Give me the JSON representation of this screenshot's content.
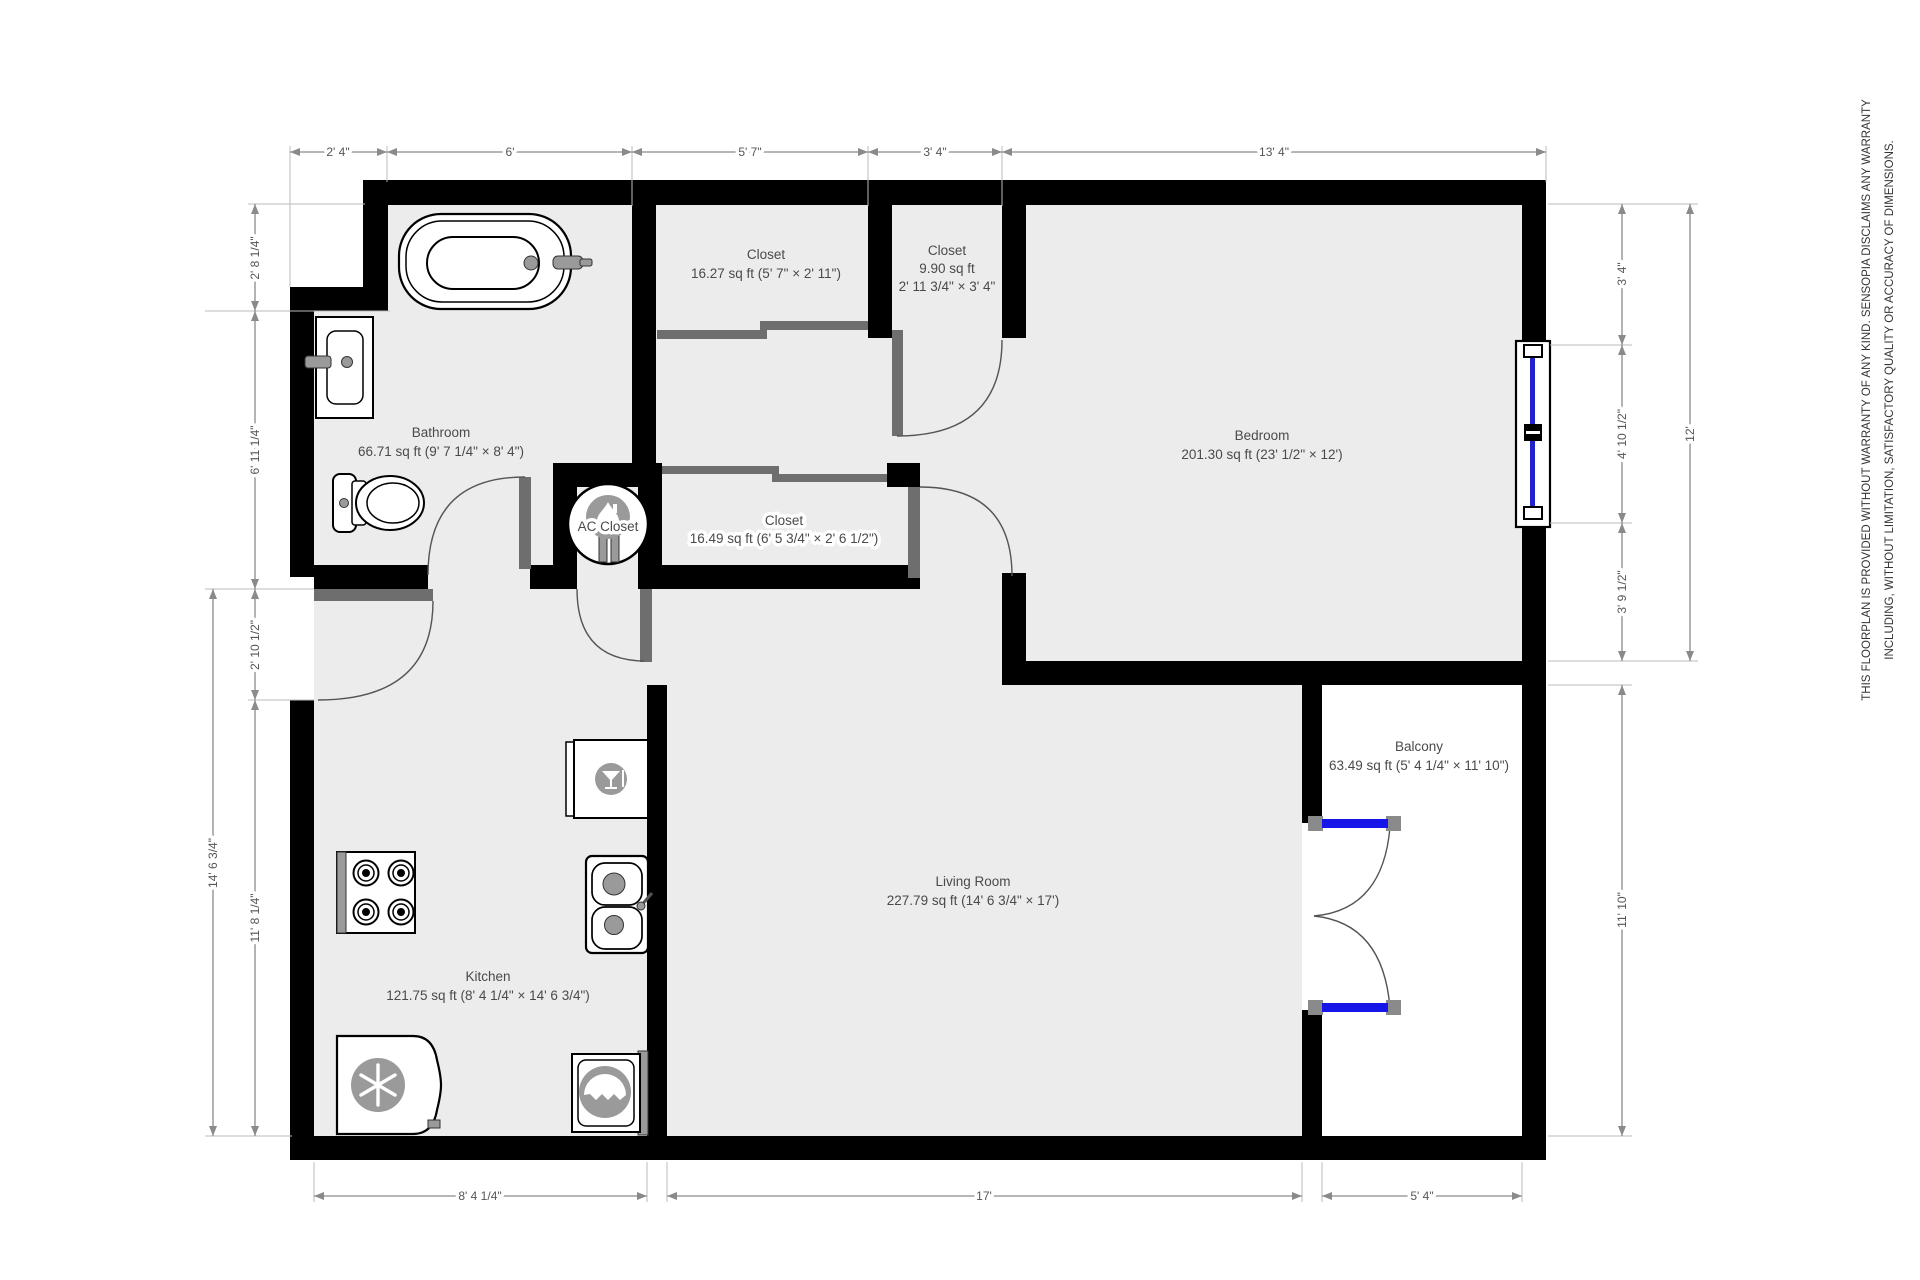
{
  "disclaimer": {
    "line1": "THIS FLOORPLAN IS PROVIDED WITHOUT WARRANTY OF ANY KIND. SENSOPIA DISCLAIMS ANY WARRANTY",
    "line2": "INCLUDING, WITHOUT LIMITATION, SATISFACTORY QUALITY OR ACCURACY OF DIMENSIONS."
  },
  "rooms": {
    "bathroom": {
      "name": "Bathroom",
      "area": "66.71 sq ft (9' 7 1/4\" × 8' 4\")"
    },
    "closet_top": {
      "name": "Closet",
      "area": "16.27 sq ft (5' 7\" × 2' 11\")"
    },
    "closet_small": {
      "name": "Closet",
      "area": "9.90 sq ft",
      "size": "2' 11 3/4\" × 3' 4\""
    },
    "bedroom": {
      "name": "Bedroom",
      "area": "201.30 sq ft (23' 1/2\" × 12')"
    },
    "ac_closet": {
      "name": "AC Closet"
    },
    "closet_hall": {
      "name": "Closet",
      "area": "16.49 sq ft (6' 5 3/4\" × 2' 6 1/2\")"
    },
    "living_room": {
      "name": "Living Room",
      "area": "227.79 sq ft (14' 6 3/4\" × 17')"
    },
    "kitchen": {
      "name": "Kitchen",
      "area": "121.75 sq ft (8' 4 1/4\" × 14' 6 3/4\")"
    },
    "balcony": {
      "name": "Balcony",
      "area": "63.49 sq ft (5' 4 1/4\" × 11' 10\")"
    }
  },
  "dimensions": {
    "top": [
      "2' 4\"",
      "6'",
      "5' 7\"",
      "3' 4\"",
      "13' 4\""
    ],
    "left_inner": [
      "2' 8 1/4\"",
      "6' 11 1/4\"",
      "2' 10 1/2\"",
      "11' 8 1/4\""
    ],
    "left_outer": "14' 6 3/4\"",
    "right_inner": [
      "3' 4\"",
      "4' 10 1/2\"",
      "3' 9 1/2\"",
      "11' 10\""
    ],
    "right_outer": "12'",
    "bottom": [
      "8' 4 1/4\"",
      "17'",
      "5' 4\""
    ]
  },
  "colors": {
    "wall": "#000000",
    "floor": "#ececec",
    "door_leaf": "#6e6e6e",
    "dimension": "#8a8a8a",
    "window_blue": "#2222cc",
    "balcony_door_blue": "#1616e8"
  }
}
